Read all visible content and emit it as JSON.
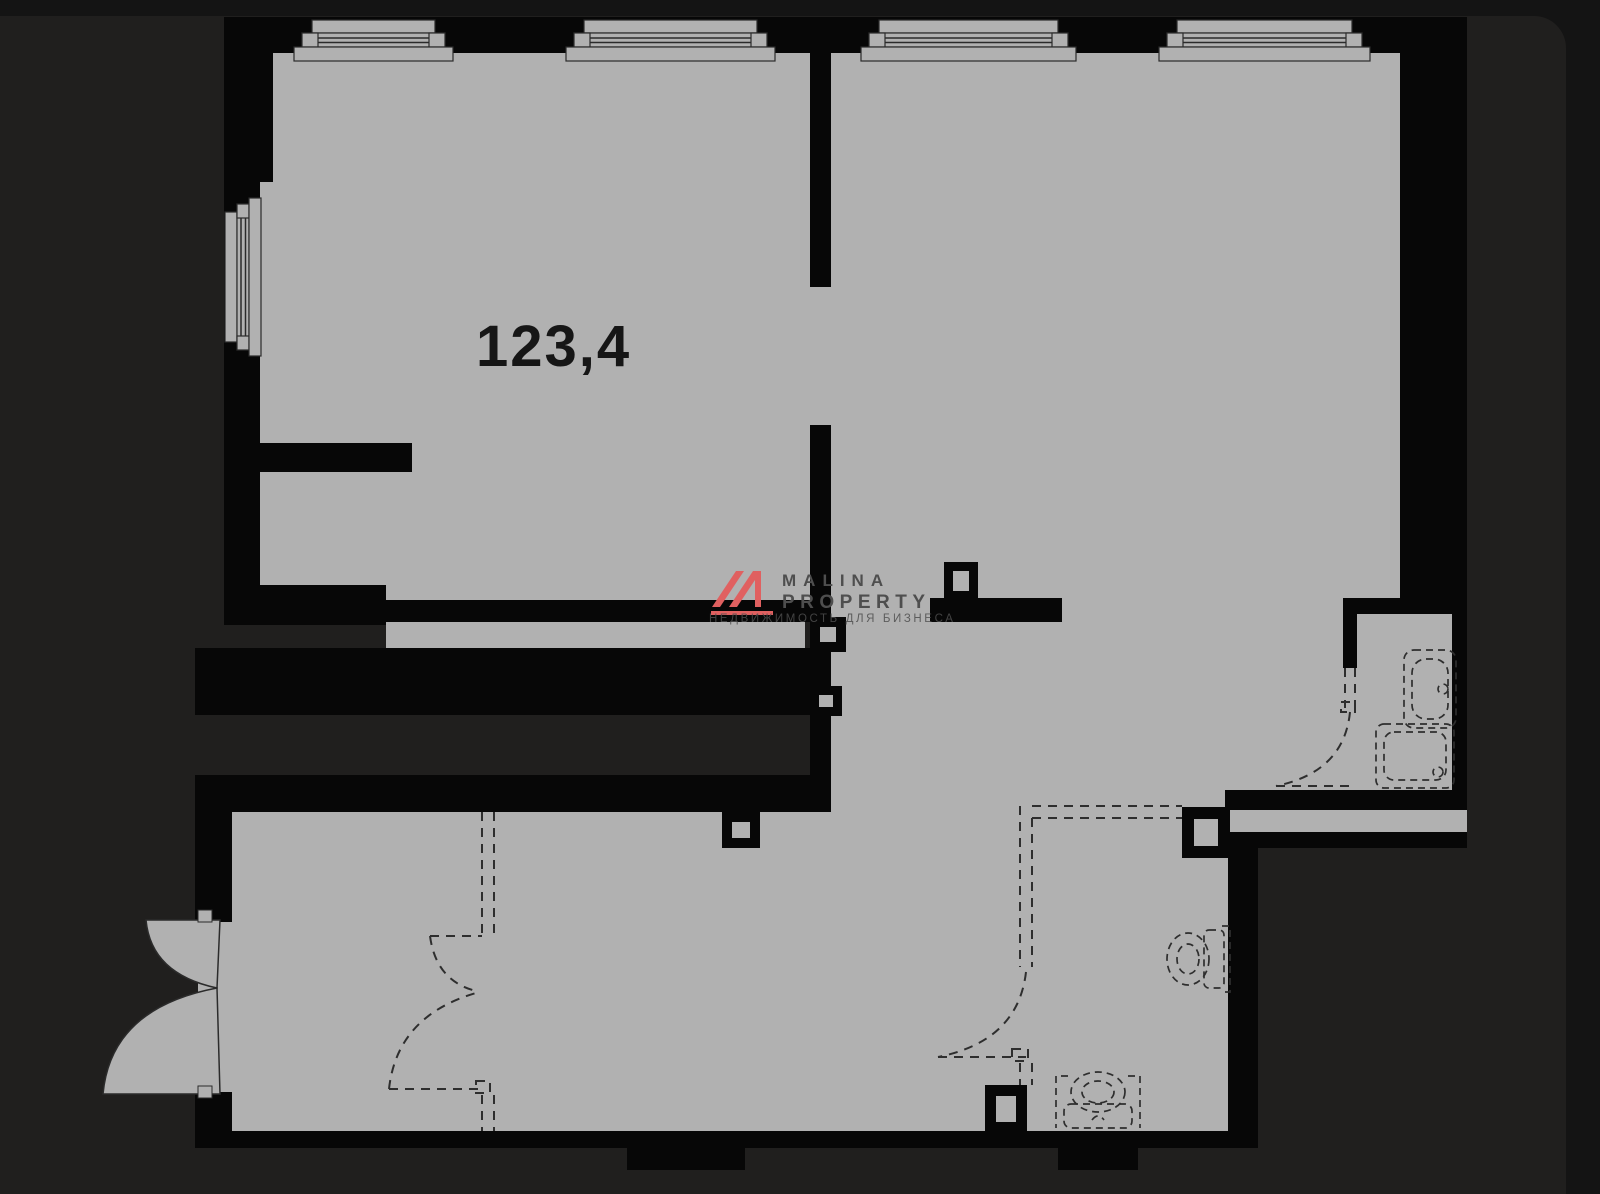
{
  "plan": {
    "area_label": "123,4"
  },
  "watermark": {
    "brand_line1": "MALINA",
    "brand_line2": "PROPERTY",
    "tagline": "НЕДВИЖИМОСТЬ ДЛЯ БИЗНЕСА"
  },
  "palette": {
    "bg": "#141414",
    "photo": "#201f1e",
    "floor": "#b1b1b1",
    "wall": "#070707",
    "dash": "#2e2e2e",
    "line": "#2b2b2b",
    "label": "#161616",
    "brand": "#e06060",
    "wmtext": "#4e4e4e"
  },
  "icons": {
    "window": "double-line frame with inner and outer sill boards",
    "door-swing": "quarter-circle swing arc",
    "planned-partition": "double dashed line",
    "toilet": "dashed oval bowl with cistern",
    "sink": "dashed basin with inner oval",
    "washer": "dashed rounded square"
  }
}
